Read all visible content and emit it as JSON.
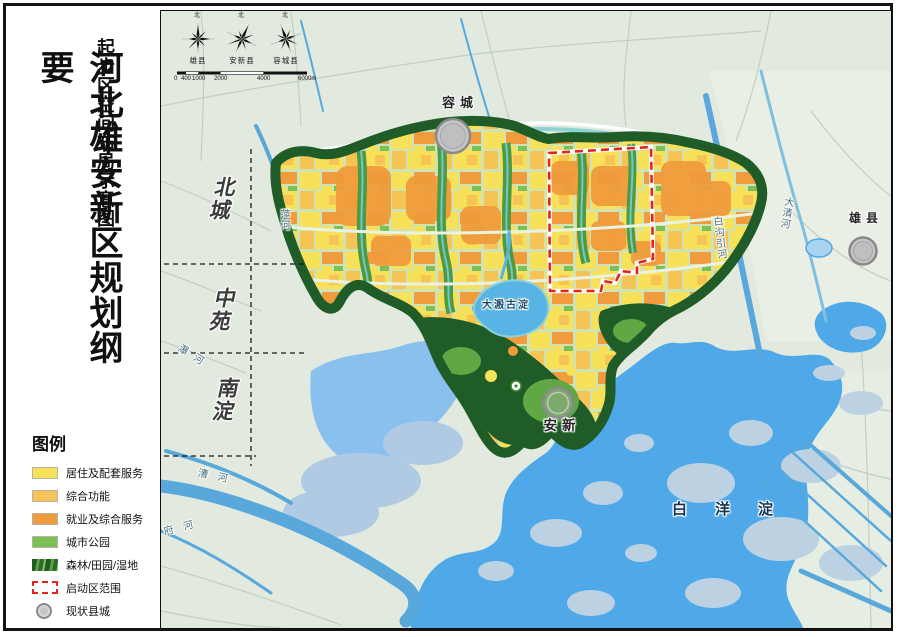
{
  "page": {
    "title_main": "河北雄安新区规划纲要",
    "title_sub": "起步区空间布局示意图"
  },
  "legend": {
    "heading": "图例",
    "items": [
      {
        "label": "居住及配套服务"
      },
      {
        "label": "综合功能"
      },
      {
        "label": "就业及综合服务"
      },
      {
        "label": "城市公园"
      },
      {
        "label": "森林/田园/湿地"
      },
      {
        "label": "启动区范围"
      },
      {
        "label": "现状县城"
      }
    ]
  },
  "compass": {
    "north_label": "北",
    "roses": [
      {
        "label": "雄县"
      },
      {
        "label": "安新县"
      },
      {
        "label": "容城县"
      }
    ]
  },
  "scalebar": {
    "ticks": [
      "0",
      "400",
      "1000",
      "2000",
      "4000",
      "6000m"
    ]
  },
  "map": {
    "zones": [
      {
        "label": "北城"
      },
      {
        "label": "中苑"
      },
      {
        "label": "南淀"
      }
    ],
    "towns": [
      {
        "label": "容城"
      },
      {
        "label": "雄县"
      },
      {
        "label": "安新"
      }
    ],
    "lake_label": "白洋淀",
    "central_wetland_label": "大溵古淀",
    "rivers": [
      {
        "label": "萍河"
      },
      {
        "label": "瀑河"
      },
      {
        "label": "漕河"
      },
      {
        "label": "府河"
      },
      {
        "label": "白沟引河"
      },
      {
        "label": "大清河"
      }
    ]
  },
  "palette": {
    "residential": "#F7E158",
    "comprehensive": "#F6C455",
    "employment": "#F09B3C",
    "park": "#7CBF52",
    "forest": "#1F5C28",
    "startup_outline": "#E3241C",
    "county_circle": "#C6C6C6",
    "lake": "#4FA9E8",
    "wetland": "#8AC0EE",
    "island": "#BCD2E2",
    "river": "#58A8DC",
    "land": "#E2EAE0"
  }
}
